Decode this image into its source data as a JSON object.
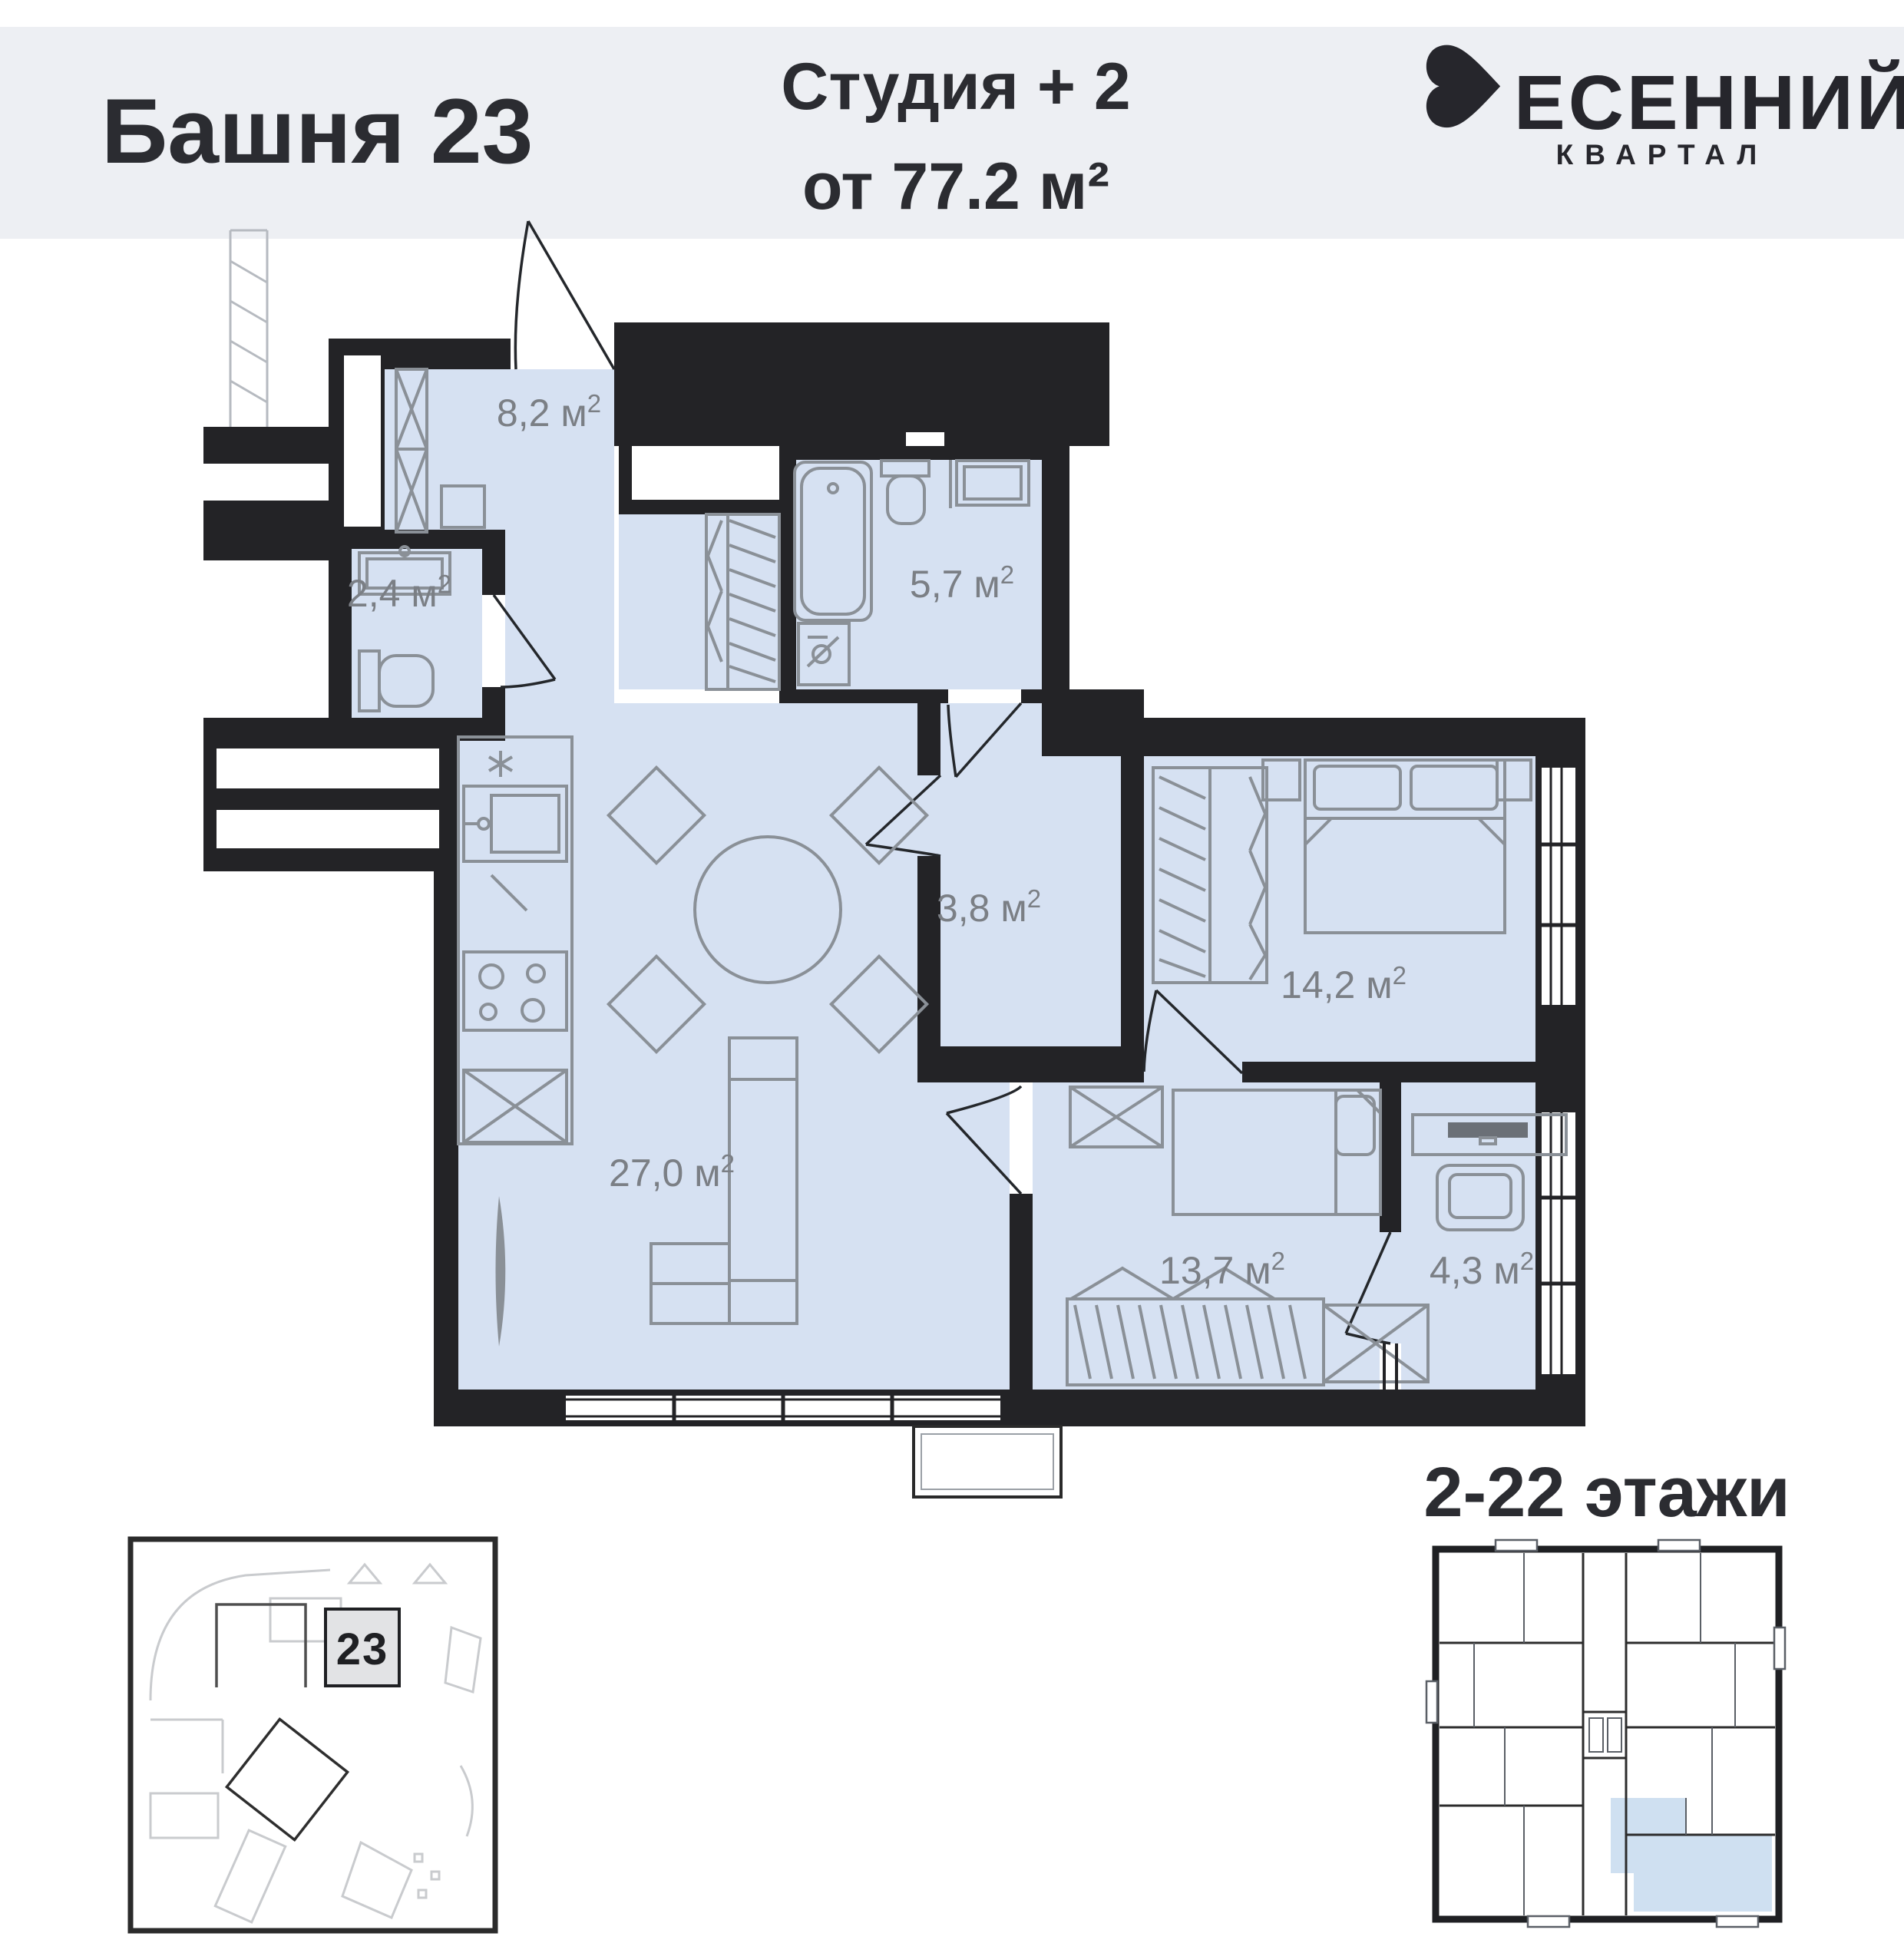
{
  "header": {
    "tower": "Башня 23",
    "unit_type": "Студия + 2",
    "unit_area": "от 77.2 м²",
    "brand_word_tail": "ЕСЕННИЙ",
    "brand_sub": "КВАРТАЛ",
    "brand_full_name": "ВЕСЕННИЙ КВАРТАЛ"
  },
  "rooms": {
    "hall": {
      "label": "8,2 м",
      "sup": "2"
    },
    "wc": {
      "label": "2,4 м",
      "sup": "2"
    },
    "bath": {
      "label": "5,7 м",
      "sup": "2"
    },
    "corridor": {
      "label": "3,8 м",
      "sup": "2"
    },
    "bedroom": {
      "label": "14,2 м",
      "sup": "2"
    },
    "living": {
      "label": "27,0 м",
      "sup": "2"
    },
    "kids": {
      "label": "13,7 м",
      "sup": "2"
    },
    "study": {
      "label": "4,3 м",
      "sup": "2"
    }
  },
  "site_map": {
    "building_number": "23"
  },
  "floors_plan": {
    "label": "2-22 этажи"
  },
  "colors": {
    "header_bg": "#edeff3",
    "room_fill": "#d6e1f2",
    "wall": "#232326",
    "furniture": "#8a9097",
    "label_text": "#7b7f85",
    "text_dark": "#2b2c31",
    "floors_highlight": "#cfe0f1",
    "map_highlight_box": "#e2e3e5"
  }
}
